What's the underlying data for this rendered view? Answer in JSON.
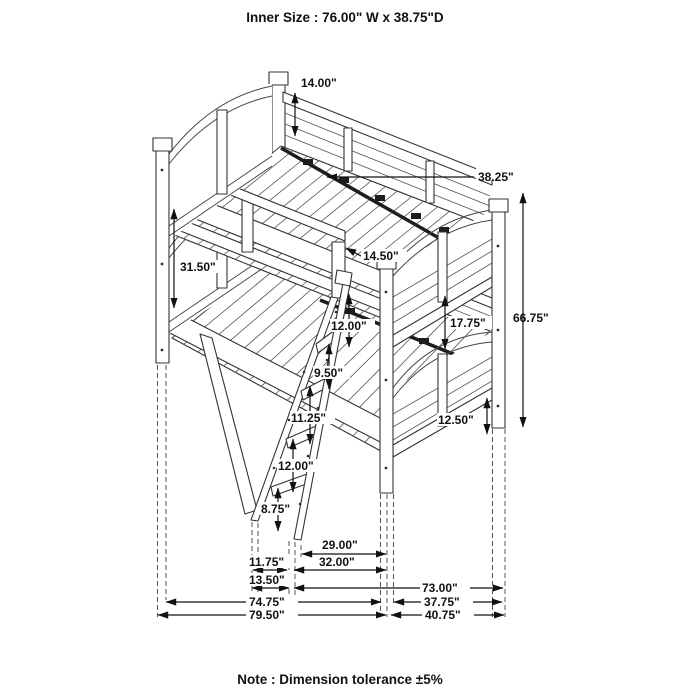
{
  "title": "Inner Size : 76.00\" W x  38.75\"D",
  "note": "Note : Dimension tolerance ±5%",
  "dims": {
    "guard_panel_height": "14.00\"",
    "slat_support_rail": "38.25\"",
    "bunk_spacing": "31.50\"",
    "ladder_opening": "14.50\"",
    "overall_height": "66.75\"",
    "under_bunk_clearance": "17.75\"",
    "rail_to_rung1": "12.00\"",
    "rung1_to_rung2": "9.50\"",
    "rung2_to_rung3": "11.25\"",
    "rung3_to_rung4": "12.00\"",
    "rung4_to_floor": "8.75\"",
    "footboard_to_floor": "12.50\"",
    "ladder_reach": "29.00\"",
    "ladder_foot_offset": "11.75\"",
    "ladder_foot_depth": "13.50\"",
    "ladder_span": "32.00\"",
    "lower_frame_length": "73.00\"",
    "inner_frame_length": "74.75\"",
    "inner_end_width": "37.75\"",
    "overall_length": "79.50\"",
    "overall_depth": "40.75\""
  }
}
